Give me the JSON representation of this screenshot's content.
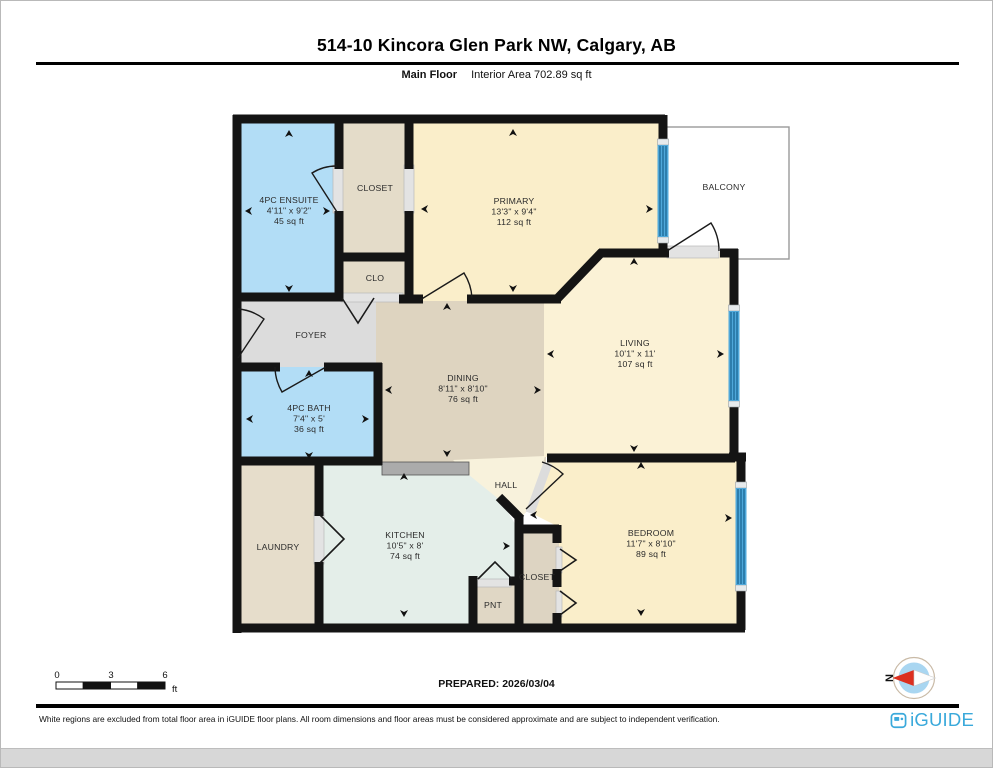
{
  "page": {
    "title": "514-10 Kincora Glen Park NW, Calgary, AB",
    "floor_label": "Main Floor",
    "interior_area": "Interior Area 702.89 sq ft",
    "prepared": "PREPARED: 2026/03/04",
    "disclaimer": "White regions are excluded from total floor area in iGUIDE floor plans. All room dimensions and floor areas must be considered approximate and are subject to independent verification.",
    "brand": "iGUIDE",
    "compass_label": "N",
    "compass_direction": "north-left"
  },
  "scale_bar": {
    "labels": [
      "0",
      "3",
      "6"
    ],
    "unit": "ft"
  },
  "colors": {
    "wall": "#141414",
    "window_blue": "#4fa8da",
    "window_stripe": "#17618f",
    "sill_gray": "#e3e3e3",
    "counter_gray": "#ababab",
    "brand_blue": "#3aa9db",
    "compass_red": "#dc2f1f",
    "compass_inner": "#a9d6f1"
  },
  "floorplan": {
    "rooms": [
      {
        "id": "balcony",
        "fill": "#ffffff",
        "stroke": "#999999",
        "rect": [
          664,
          126,
          124,
          132
        ],
        "label": {
          "x": 723,
          "y": 189,
          "lines": [
            "BALCONY"
          ]
        }
      },
      {
        "id": "foyer",
        "fill": "#dcdcdc",
        "poly": [
          [
            232,
            294
          ],
          [
            384,
            294
          ],
          [
            394,
            368
          ],
          [
            232,
            368
          ]
        ],
        "label": {
          "x": 310,
          "y": 337,
          "lines": [
            "FOYER"
          ]
        }
      },
      {
        "id": "dining",
        "fill": "#ded4c0",
        "rect": [
          375,
          294,
          170,
          170
        ],
        "label": {
          "x": 462,
          "y": 380,
          "lines": [
            "DINING",
            "8'11\" x 8'10\"",
            "76 sq ft"
          ]
        }
      },
      {
        "id": "hall",
        "fill": "#f8f2dc",
        "poly": [
          [
            452,
            459
          ],
          [
            544,
            455
          ],
          [
            529,
            507
          ],
          [
            517,
            520
          ],
          [
            500,
            502
          ],
          [
            464,
            471
          ]
        ],
        "label": {
          "x": 505,
          "y": 487,
          "lines": [
            "HALL"
          ]
        }
      },
      {
        "id": "living",
        "fill": "#fbf2d6",
        "poly": [
          [
            543,
            296
          ],
          [
            558,
            296
          ],
          [
            601,
            251
          ],
          [
            737,
            251
          ],
          [
            737,
            456
          ],
          [
            543,
            456
          ]
        ],
        "label": {
          "x": 634,
          "y": 345,
          "lines": [
            "LIVING",
            "10'1\" x 11'",
            "107 sq ft"
          ]
        }
      },
      {
        "id": "primary",
        "fill": "#faeeca",
        "poly": [
          [
            410,
            116
          ],
          [
            664,
            116
          ],
          [
            664,
            256
          ],
          [
            598,
            256
          ],
          [
            556,
            300
          ],
          [
            410,
            300
          ]
        ],
        "label": {
          "x": 513,
          "y": 203,
          "lines": [
            "PRIMARY",
            "13'3\" x 9'4\"",
            "112 sq ft"
          ]
        }
      },
      {
        "id": "ensuite",
        "fill": "#b2ddf6",
        "rect": [
          236,
          116,
          104,
          182
        ],
        "label": {
          "x": 288,
          "y": 202,
          "lines": [
            "4PC ENSUITE",
            "4'11\" x 9'2\"",
            "45 sq ft"
          ]
        }
      },
      {
        "id": "closet-top",
        "fill": "#e4dcc9",
        "rect": [
          336,
          116,
          74,
          142
        ],
        "label": {
          "x": 374,
          "y": 190,
          "lines": [
            "CLOSET"
          ]
        }
      },
      {
        "id": "clo",
        "fill": "#e4dcc9",
        "rect": [
          336,
          252,
          74,
          48
        ],
        "label": {
          "x": 374,
          "y": 280,
          "lines": [
            "CLO"
          ]
        }
      },
      {
        "id": "bath",
        "fill": "#b2ddf6",
        "rect": [
          236,
          366,
          142,
          96
        ],
        "label": {
          "x": 308,
          "y": 410,
          "lines": [
            "4PC BATH",
            "7'4\" x 5'",
            "36 sq ft"
          ]
        }
      },
      {
        "id": "laundry",
        "fill": "#e6ddcb",
        "rect": [
          236,
          460,
          84,
          168
        ],
        "label": {
          "x": 277,
          "y": 549,
          "lines": [
            "LAUNDRY"
          ]
        }
      },
      {
        "id": "kitchen",
        "fill": "#e4eee9",
        "poly": [
          [
            320,
            462
          ],
          [
            468,
            462
          ],
          [
            468,
            474
          ],
          [
            500,
            500
          ],
          [
            516,
            526
          ],
          [
            516,
            578
          ],
          [
            472,
            578
          ],
          [
            472,
            628
          ],
          [
            320,
            628
          ]
        ],
        "label": {
          "x": 404,
          "y": 537,
          "lines": [
            "KITCHEN",
            "10'5\" x 8'",
            "74 sq ft"
          ]
        }
      },
      {
        "id": "pnt",
        "fill": "#e0d7c5",
        "rect": [
          470,
          578,
          45,
          50
        ],
        "label": {
          "x": 492,
          "y": 607,
          "lines": [
            "PNT"
          ]
        }
      },
      {
        "id": "closet-bottom",
        "fill": "#ddd4c2",
        "rect": [
          514,
          524,
          44,
          104
        ],
        "label": {
          "x": 536,
          "y": 579,
          "lines": [
            "CLOSET"
          ]
        }
      },
      {
        "id": "bedroom",
        "fill": "#faeeca",
        "poly": [
          [
            548,
            458
          ],
          [
            737,
            458
          ],
          [
            737,
            625
          ],
          [
            558,
            625
          ],
          [
            558,
            526
          ],
          [
            526,
            510
          ]
        ],
        "label": {
          "x": 650,
          "y": 535,
          "lines": [
            "BEDROOM",
            "11'7\" x 8'10\"",
            "89 sq ft"
          ]
        }
      }
    ],
    "walls": [
      [
        232,
        118,
        664,
        118
      ],
      [
        236,
        114,
        236,
        632
      ],
      [
        232,
        627,
        744,
        627
      ],
      [
        740,
        629,
        740,
        583
      ],
      [
        740,
        490,
        740,
        452
      ],
      [
        728,
        456,
        745,
        456
      ],
      [
        733,
        458,
        733,
        400
      ],
      [
        733,
        310,
        733,
        248
      ],
      [
        737,
        252,
        719,
        252
      ],
      [
        598,
        252,
        668,
        252
      ],
      [
        662,
        114,
        662,
        148
      ],
      [
        662,
        234,
        662,
        256
      ],
      [
        556,
        298,
        601,
        251
      ],
      [
        466,
        298,
        560,
        298
      ],
      [
        398,
        298,
        422,
        298
      ],
      [
        338,
        114,
        338,
        168
      ],
      [
        338,
        210,
        338,
        300
      ],
      [
        232,
        296,
        342,
        296
      ],
      [
        334,
        256,
        412,
        256
      ],
      [
        408,
        114,
        408,
        168
      ],
      [
        408,
        210,
        408,
        300
      ],
      [
        232,
        366,
        279,
        366
      ],
      [
        323,
        366,
        381,
        366
      ],
      [
        377,
        362,
        377,
        464
      ],
      [
        232,
        460,
        381,
        460
      ],
      [
        318,
        456,
        318,
        515
      ],
      [
        318,
        561,
        318,
        631
      ],
      [
        472,
        575,
        472,
        631
      ],
      [
        508,
        580,
        520,
        580
      ],
      [
        518,
        514,
        518,
        631
      ],
      [
        514,
        528,
        558,
        528
      ],
      [
        556,
        524,
        556,
        542
      ],
      [
        556,
        568,
        556,
        586
      ],
      [
        556,
        612,
        556,
        631
      ],
      [
        498,
        496,
        520,
        518
      ],
      [
        546,
        457,
        734,
        457
      ]
    ],
    "windows": [
      {
        "x": 656.5,
        "y": 144,
        "w": 11,
        "h": 92
      },
      {
        "x": 727.5,
        "y": 310,
        "w": 11,
        "h": 90
      },
      {
        "x": 734.5,
        "y": 487,
        "w": 11,
        "h": 97
      }
    ],
    "sills": [
      [
        332,
        164,
        10,
        48
      ],
      [
        403,
        164,
        10,
        48
      ],
      [
        340,
        292,
        62,
        9
      ],
      [
        666,
        245,
        52,
        12
      ],
      [
        313,
        511,
        10,
        52
      ],
      [
        475,
        578,
        35,
        8
      ],
      [
        555,
        546,
        6,
        26
      ],
      [
        555,
        590,
        6,
        26
      ]
    ],
    "diag_sills": [
      {
        "x1": 529,
        "y1": 512,
        "x2": 547,
        "y2": 462,
        "w": 9
      }
    ],
    "doors": [
      "M336,211 L311,172 A46,46 0 0 1 336,165",
      "M419,299 L463,272 A52,52 0 0 1 471,297",
      "M325,366 L281,391 A51,51 0 0 1 274,366",
      "M237,357 L263,318 A48,48 0 0 0 237,308",
      "M666,250 L710,222 A52,52 0 0 1 718,250",
      "M525,508 L562,473 A51,51 0 0 0 541,461"
    ],
    "bifolds": [
      "341,297 357,322 373,297",
      "319,514 343,538 319,562",
      "477,578 494,561 511,578",
      "559,548 575,559 559,570",
      "559,590 575,602 559,614"
    ],
    "arrows": [
      {
        "x": 288,
        "y": 133,
        "d": "up"
      },
      {
        "x": 288,
        "y": 287,
        "d": "down"
      },
      {
        "x": 248,
        "y": 210,
        "d": "left"
      },
      {
        "x": 325,
        "y": 210,
        "d": "right"
      },
      {
        "x": 512,
        "y": 132,
        "d": "up"
      },
      {
        "x": 512,
        "y": 287,
        "d": "down"
      },
      {
        "x": 424,
        "y": 208,
        "d": "left"
      },
      {
        "x": 648,
        "y": 208,
        "d": "right"
      },
      {
        "x": 633,
        "y": 261,
        "d": "up"
      },
      {
        "x": 633,
        "y": 447,
        "d": "down"
      },
      {
        "x": 550,
        "y": 353,
        "d": "left"
      },
      {
        "x": 719,
        "y": 353,
        "d": "right"
      },
      {
        "x": 446,
        "y": 306,
        "d": "up"
      },
      {
        "x": 446,
        "y": 452,
        "d": "down"
      },
      {
        "x": 388,
        "y": 389,
        "d": "left"
      },
      {
        "x": 536,
        "y": 389,
        "d": "right"
      },
      {
        "x": 308,
        "y": 373,
        "d": "up"
      },
      {
        "x": 308,
        "y": 454,
        "d": "down"
      },
      {
        "x": 249,
        "y": 418,
        "d": "left"
      },
      {
        "x": 364,
        "y": 418,
        "d": "right"
      },
      {
        "x": 403,
        "y": 476,
        "d": "up"
      },
      {
        "x": 403,
        "y": 612,
        "d": "down"
      },
      {
        "x": 505,
        "y": 545,
        "d": "right"
      },
      {
        "x": 640,
        "y": 465,
        "d": "up"
      },
      {
        "x": 640,
        "y": 611,
        "d": "down"
      },
      {
        "x": 533,
        "y": 514,
        "d": "left"
      },
      {
        "x": 727,
        "y": 517,
        "d": "right"
      }
    ],
    "counter": [
      381,
      461,
      87,
      13
    ]
  }
}
